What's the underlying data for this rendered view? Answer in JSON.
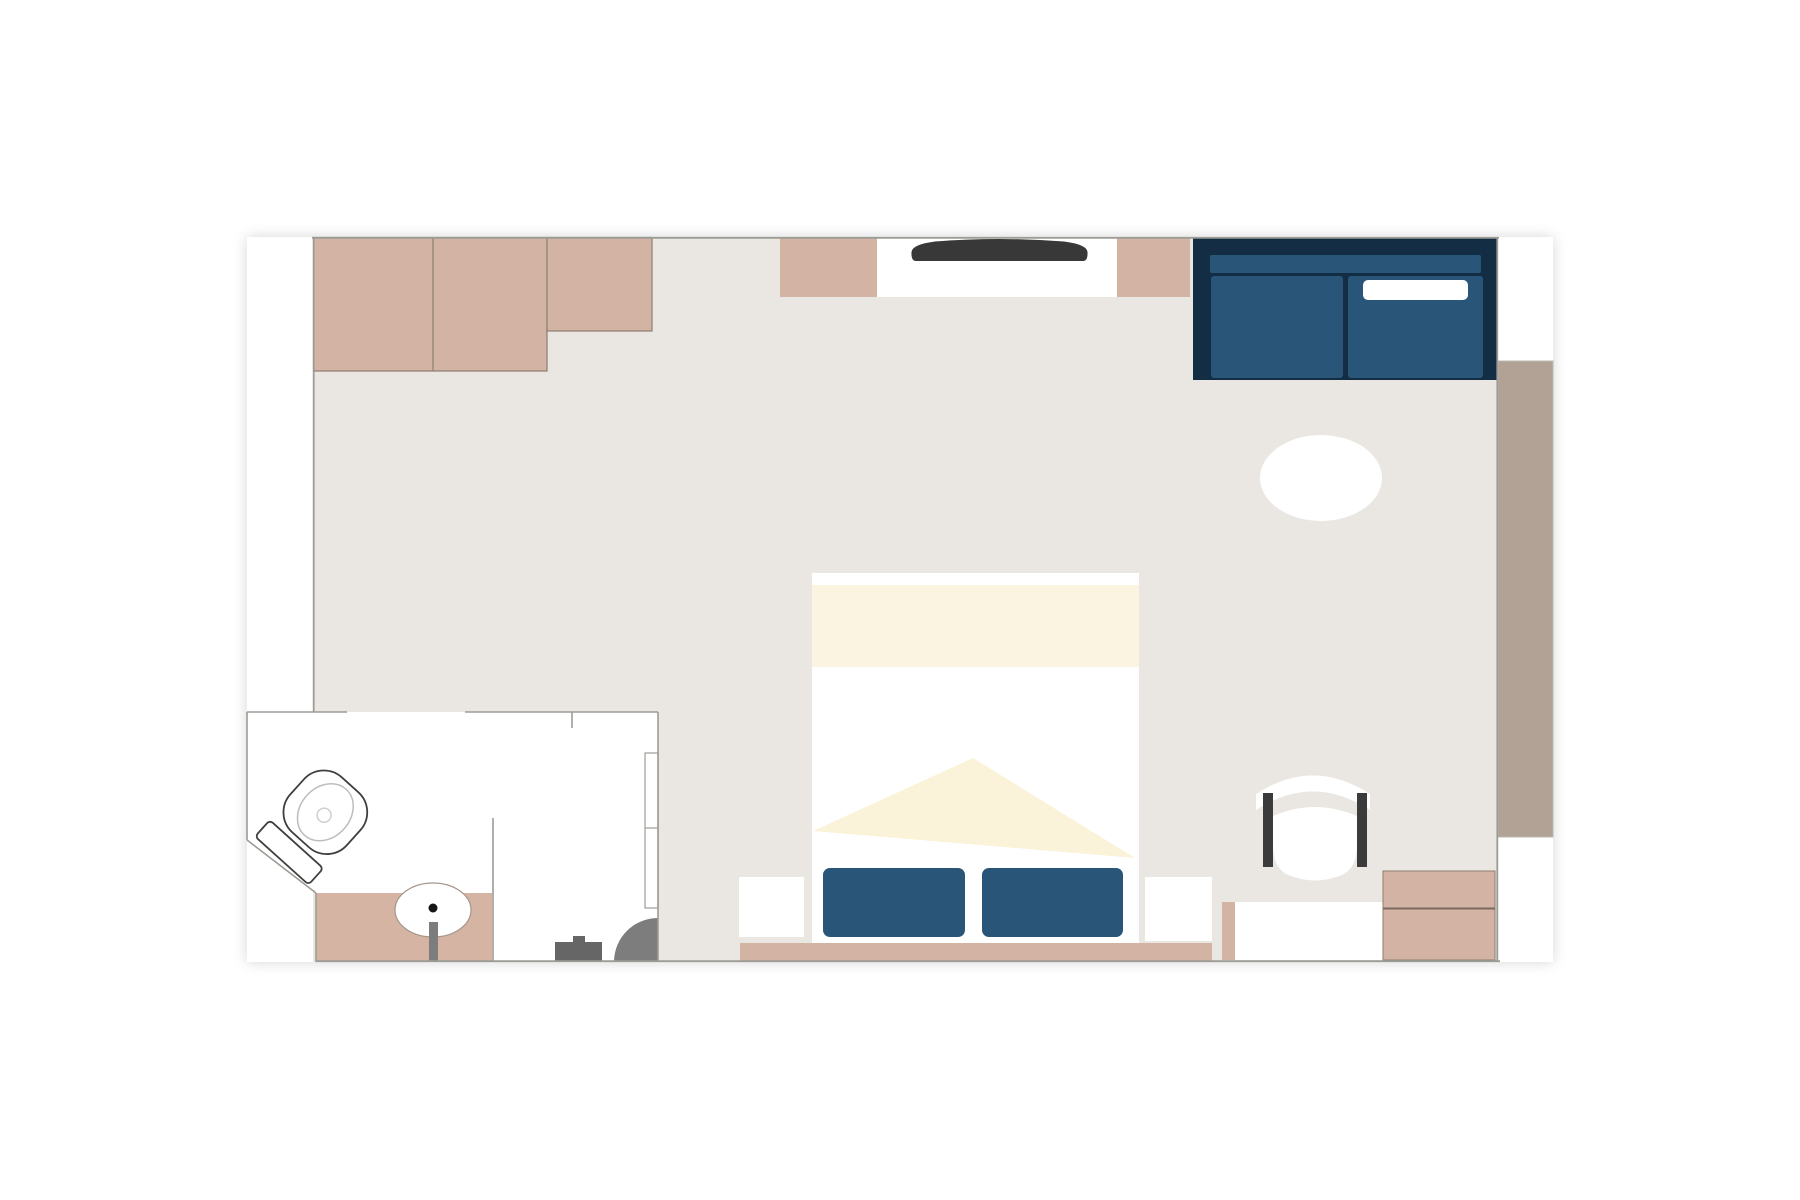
{
  "canvas": {
    "width": 1800,
    "height": 1200,
    "background": "#ffffff"
  },
  "diagram": {
    "type": "floor-plan",
    "subject": "hotel-room-with-ensuite-bathroom",
    "palette": {
      "floor": "#EAE7E2",
      "wall_line": "#9C9C96",
      "tan_light": "#D3B3A4",
      "tan_counter": "#D6B4A4",
      "tan_balcony": "#B2A296",
      "navy_dark": "#132E44",
      "navy_mid": "#295678",
      "cream_band": "#FBF4E1",
      "cream_throw": "#FAF3D9",
      "white": "#FFFFFF",
      "dark_gray": "#3B3B3B",
      "mid_gray": "#7D7D7D",
      "outline_brown": "#8E7D72",
      "toilet_outline": "#3F3F3F"
    },
    "rooms": [
      {
        "name": "bedroom",
        "floor": "#EAE7E2"
      },
      {
        "name": "bathroom",
        "floor": "#FFFFFF"
      },
      {
        "name": "balcony-deck",
        "floor": "#B2A296"
      }
    ],
    "furniture": [
      "wardrobe-unit-left",
      "wardrobe-unit-small",
      "wall-pillar-left",
      "tv-niche",
      "wall-tv",
      "wall-pillar-right",
      "navy-sofa",
      "sofa-back-rail",
      "sofa-cushions",
      "sofa-white-pillow",
      "oval-side-table",
      "double-bed",
      "bed-foot-band",
      "bed-throw-triangle",
      "bed-pillow-left",
      "bed-pillow-right",
      "nightstand-left",
      "nightstand-right",
      "headboard-bench-strip",
      "armchair",
      "console-bench",
      "dresser-stack",
      "vanity-counter",
      "sink-basin",
      "faucet",
      "toilet",
      "shower-partition",
      "shower-sliding-panel",
      "entry-door-swing",
      "floor-fixture"
    ]
  }
}
